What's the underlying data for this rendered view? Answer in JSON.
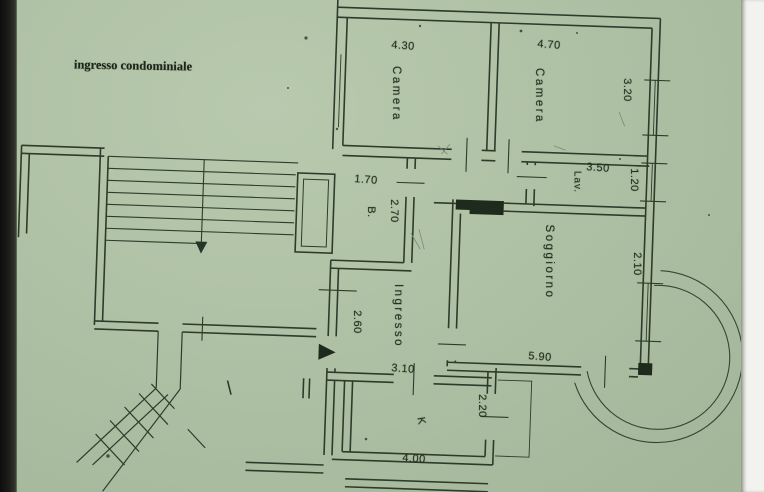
{
  "colors": {
    "paper": "#afc1a5",
    "ink": "#2e3b2b",
    "scan_edge_left": "#1d1d1b",
    "scan_edge_right": "#f2f2ef"
  },
  "labels": {
    "site_note": "ingresso condominiale",
    "camera1_name": "Camera",
    "camera1_width": "4.30",
    "camera2_name": "Camera",
    "camera2_width": "4.70",
    "camera2_depth": "3.20",
    "bath_name": "B.",
    "bath_width": "1.70",
    "bath_depth": "2.70",
    "lav_name": "Lav.",
    "lav_width": "3.50",
    "lav_depth": "1.20",
    "soggiorno_name": "Soggiorno",
    "soggiorno_width": "5.90",
    "soggiorno_depth": "2.10",
    "ingresso_name": "Ingresso",
    "ingresso_width": "3.10",
    "ingresso_depth": "2.60",
    "kitchen_name": "K",
    "kitchen_width": "4.00",
    "kitchen_depth": "2.20"
  }
}
